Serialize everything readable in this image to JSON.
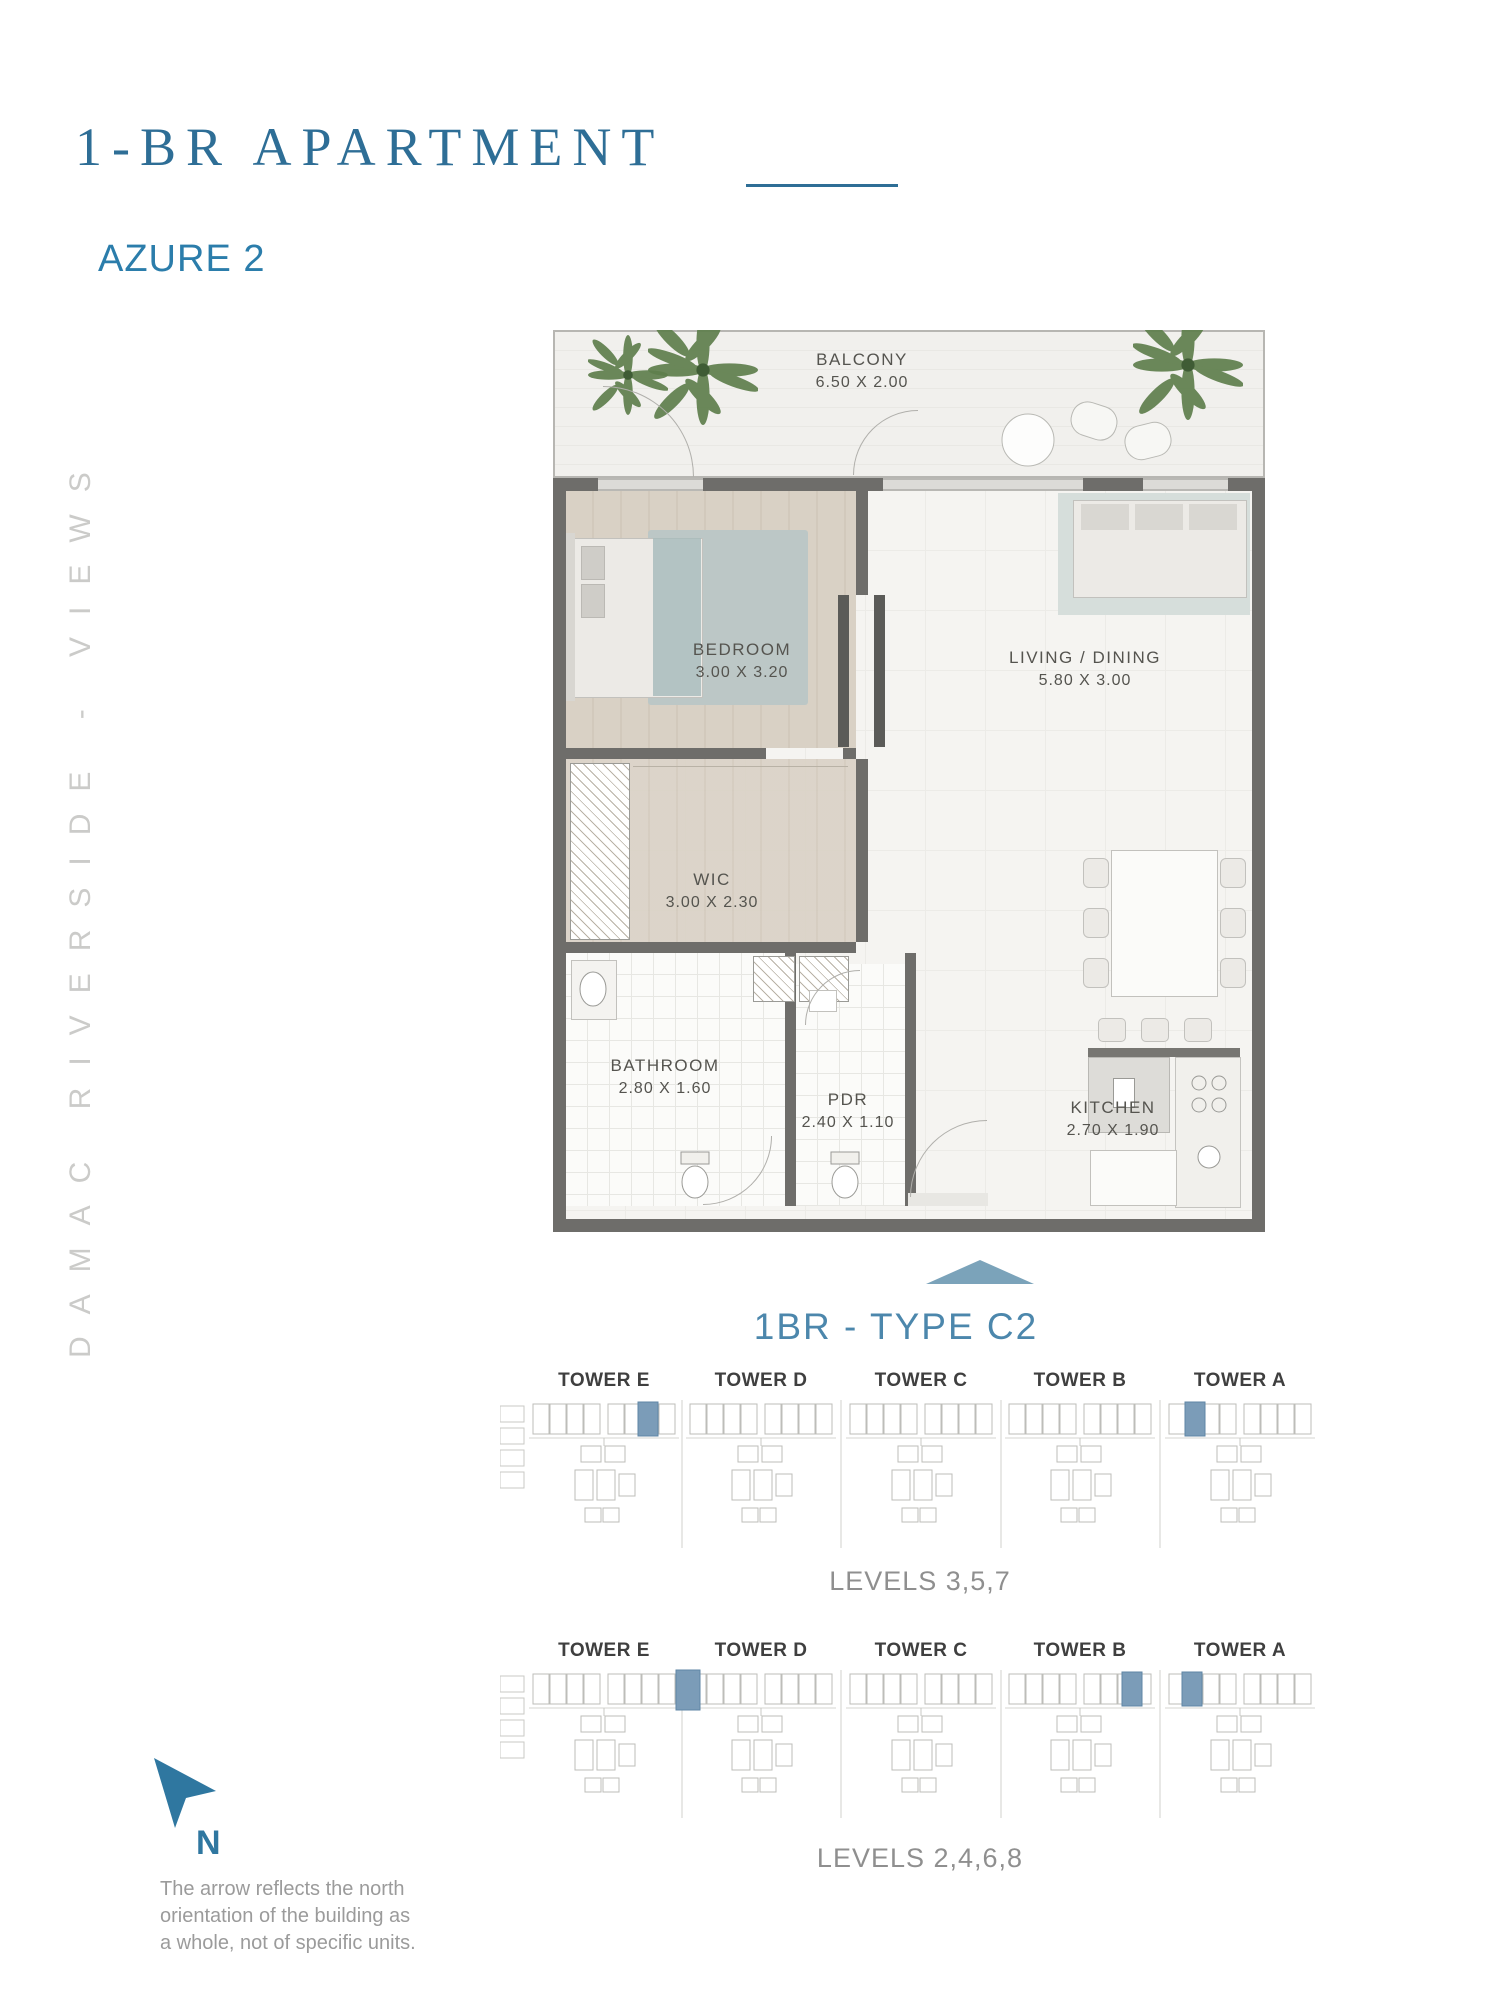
{
  "page": {
    "title": "1-BR APARTMENT",
    "subtitle": "AZURE 2",
    "side_text": "DAMAC RIVERSIDE - VIEWS"
  },
  "floor_plan": {
    "type_label": "1BR - TYPE C2",
    "rooms": [
      {
        "name": "BALCONY",
        "dims": "6.50 X 2.00"
      },
      {
        "name": "BEDROOM",
        "dims": "3.00 X 3.20"
      },
      {
        "name": "LIVING / DINING",
        "dims": "5.80 X 3.00"
      },
      {
        "name": "WIC",
        "dims": "3.00 X 2.30"
      },
      {
        "name": "BATHROOM",
        "dims": "2.80 X 1.60"
      },
      {
        "name": "PDR",
        "dims": "2.40 X 1.10"
      },
      {
        "name": "KITCHEN",
        "dims": "2.70 X 1.90"
      }
    ]
  },
  "key_plans": [
    {
      "towers": [
        "TOWER E",
        "TOWER D",
        "TOWER C",
        "TOWER B",
        "TOWER A"
      ],
      "levels_label": "LEVELS 3,5,7"
    },
    {
      "towers": [
        "TOWER E",
        "TOWER D",
        "TOWER C",
        "TOWER B",
        "TOWER A"
      ],
      "levels_label": "LEVELS 2,4,6,8"
    }
  ],
  "north_note": {
    "letter": "N",
    "line1": "The arrow reflects the north",
    "line2": "orientation of  the building as",
    "line3": "a whole, not of specific units."
  },
  "colors": {
    "accent": "#2e6e96",
    "subtitle": "#2b7dab",
    "type_label": "#4c87ac",
    "pointer": "#7ba3ba",
    "north_arrow": "#2f77a0",
    "tower_highlight": "#7b9cb8"
  }
}
